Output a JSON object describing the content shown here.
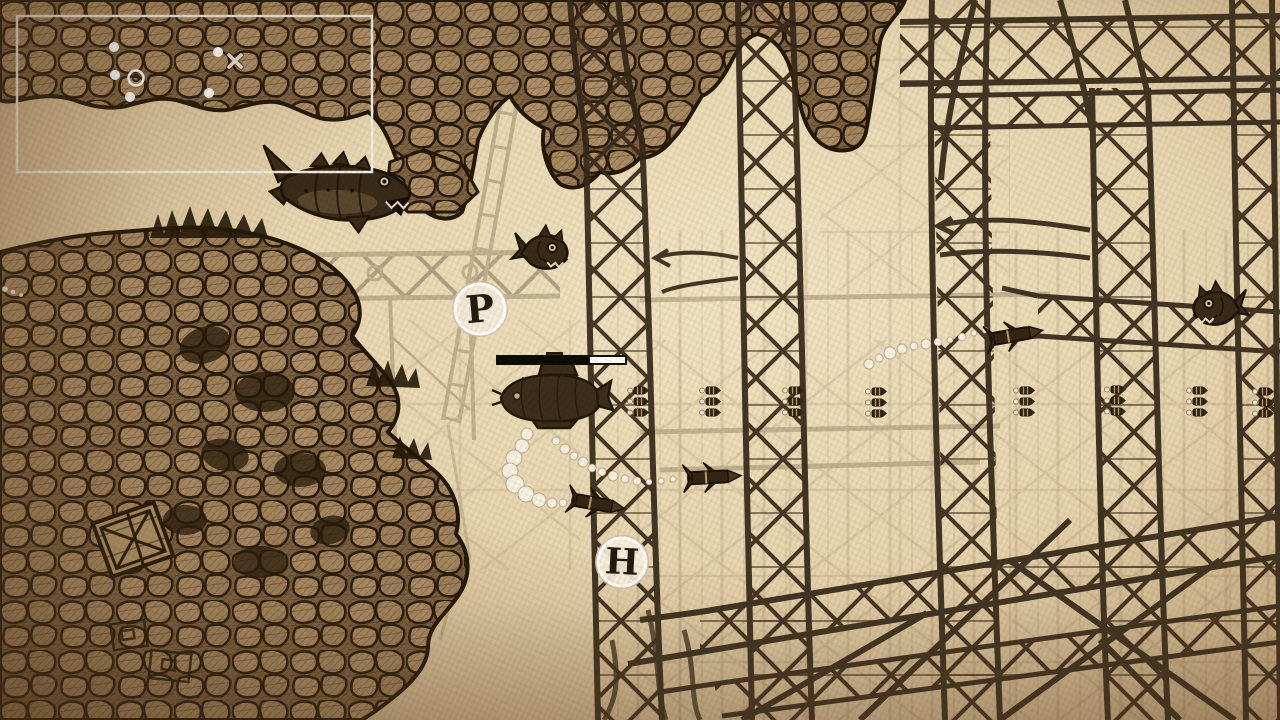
{
  "scene": {
    "width": 1280,
    "height": 720,
    "description": "Hand-sketched sepia underwater side-scroller: submarine among sunken trusses and rocks"
  },
  "colors": {
    "paper": "#e7d6b0",
    "paper_light": "#f1e4c4",
    "paper_dark": "#bfa076",
    "ink": "#241808",
    "ink_mid": "#3a2a18",
    "rock_fill": "#7d6342",
    "stone": "#b09068",
    "white": "#ffffff"
  },
  "hud": {
    "minimap": {
      "x": 17,
      "y": 16,
      "width": 355,
      "height": 156,
      "border_color": "#f2efe6",
      "blips": [
        {
          "x": 97,
          "y": 31
        },
        {
          "x": 98,
          "y": 59
        },
        {
          "x": 113,
          "y": 81
        },
        {
          "x": 201,
          "y": 36
        },
        {
          "x": 192,
          "y": 77
        }
      ],
      "player_marker": {
        "x": 119,
        "y": 62
      },
      "cross_marker": {
        "x": 218,
        "y": 45
      }
    },
    "health_bar": {
      "x": 497,
      "y": 356,
      "width": 129,
      "height": 8,
      "fill_percent": 72,
      "fill_color": "#0d0b06",
      "empty_color": "#ffffff"
    }
  },
  "pickups": {
    "p": {
      "label": "P",
      "x": 480,
      "y": 309,
      "radius": 25
    },
    "h": {
      "label": "H",
      "x": 622,
      "y": 562,
      "radius": 24
    }
  },
  "player": {
    "type": "submarine",
    "x": 553,
    "y": 396,
    "facing": "left"
  },
  "enemies": [
    {
      "type": "mecha-shark",
      "x": 340,
      "y": 192,
      "angle": 2,
      "facing": "right"
    },
    {
      "type": "piranha",
      "x": 544,
      "y": 251,
      "angle": 4,
      "facing": "right"
    },
    {
      "type": "piranha",
      "x": 1217,
      "y": 307,
      "angle": -3,
      "facing": "left"
    }
  ],
  "projectiles": [
    {
      "type": "torpedo",
      "x": 598,
      "y": 504,
      "angle": 10
    },
    {
      "type": "torpedo",
      "x": 714,
      "y": 477,
      "angle": -3
    },
    {
      "type": "torpedo",
      "x": 1016,
      "y": 335,
      "angle": -10
    },
    {
      "type": "bomb",
      "x": 516,
      "y": 400,
      "angle": 0
    }
  ],
  "props": [
    {
      "type": "crate",
      "x": 131,
      "y": 540,
      "angle": -12
    }
  ],
  "ammo_pickups": [
    {
      "x": 628,
      "y": 387
    },
    {
      "x": 700,
      "y": 387
    },
    {
      "x": 783,
      "y": 387
    },
    {
      "x": 866,
      "y": 388
    },
    {
      "x": 1014,
      "y": 387
    },
    {
      "x": 1105,
      "y": 386
    },
    {
      "x": 1187,
      "y": 387
    },
    {
      "x": 1253,
      "y": 388
    }
  ],
  "bubbles": {
    "chains": [
      [
        [
          527,
          434,
          6
        ],
        [
          522,
          446,
          7
        ],
        [
          514,
          458,
          8
        ],
        [
          510,
          471,
          8
        ],
        [
          515,
          484,
          9
        ],
        [
          526,
          494,
          8
        ],
        [
          539,
          500,
          7
        ],
        [
          552,
          503,
          5
        ],
        [
          563,
          503,
          4
        ]
      ],
      [
        [
          556,
          441,
          4
        ],
        [
          565,
          449,
          5
        ],
        [
          574,
          456,
          4
        ],
        [
          583,
          462,
          5
        ],
        [
          592,
          468,
          4
        ],
        [
          602,
          472,
          4
        ],
        [
          613,
          476,
          5
        ],
        [
          625,
          479,
          4
        ],
        [
          637,
          481,
          4
        ],
        [
          649,
          482,
          3
        ],
        [
          661,
          481,
          3
        ],
        [
          673,
          479,
          3
        ]
      ],
      [
        [
          869,
          364,
          5
        ],
        [
          879,
          358,
          4
        ],
        [
          890,
          353,
          6
        ],
        [
          902,
          349,
          5
        ],
        [
          914,
          346,
          4
        ],
        [
          926,
          344,
          5
        ],
        [
          938,
          342,
          4
        ],
        [
          950,
          340,
          3
        ],
        [
          962,
          337,
          4
        ],
        [
          974,
          333,
          3
        ],
        [
          985,
          330,
          3
        ]
      ],
      [
        [
          5,
          289,
          3
        ],
        [
          13,
          292,
          2.5
        ],
        [
          21,
          295,
          2
        ]
      ]
    ]
  }
}
